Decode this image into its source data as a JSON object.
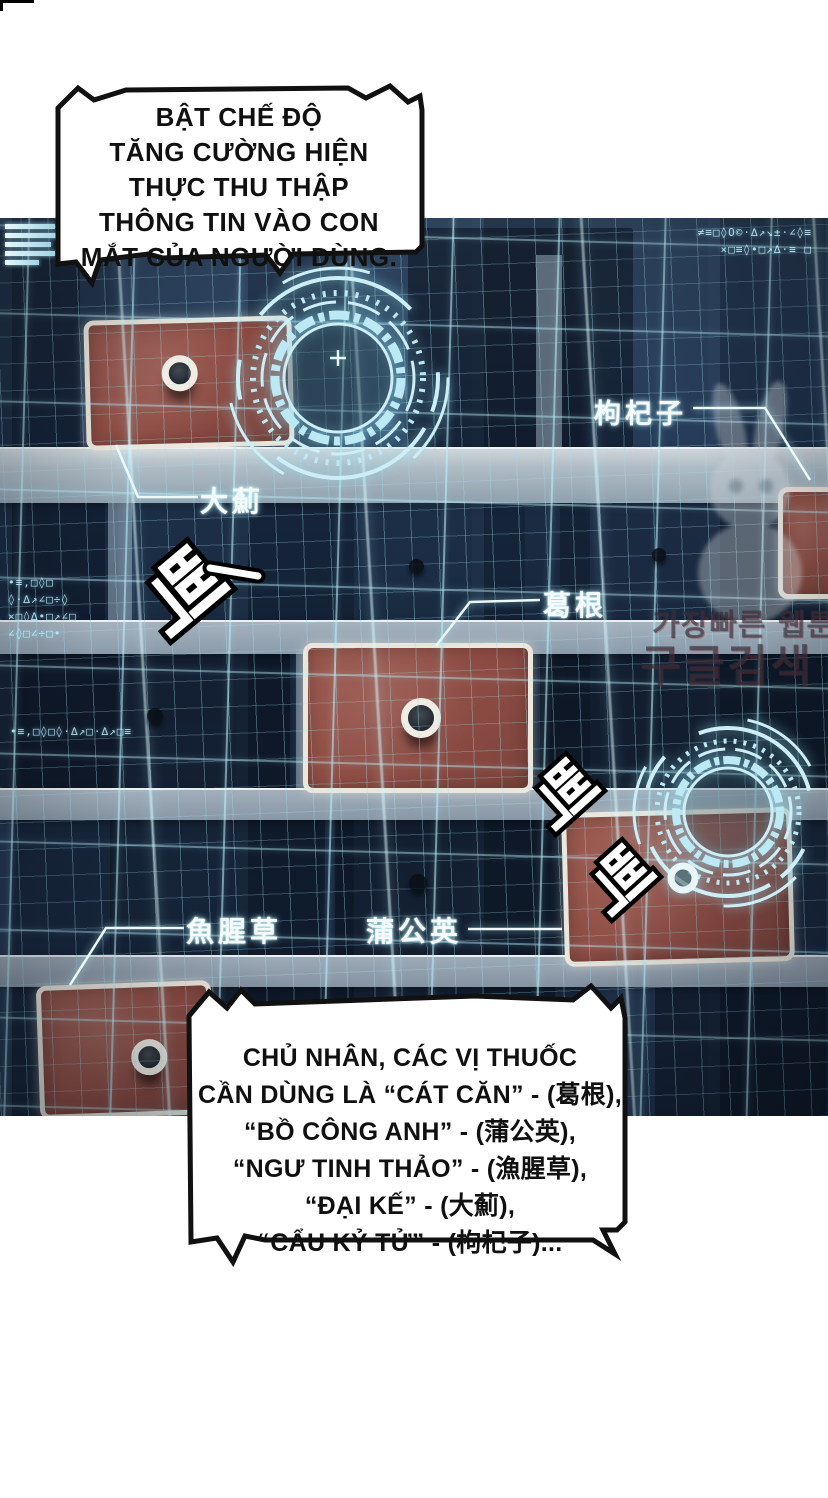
{
  "bubbles": {
    "top": {
      "lines": [
        "BẬT CHẾ ĐỘ",
        "TĂNG CƯỜNG HIỆN",
        "THỰC THU THẬP",
        "THÔNG TIN VÀO CON",
        "MẮT CỦA NGƯỜI DÙNG."
      ]
    },
    "bottom": {
      "lines": [
        "CHỦ NHÂN, CÁC VỊ THUỐC",
        "CẦN DÙNG LÀ “CÁT CĂN” - (葛根),",
        "“BỒ CÔNG ANH” - (蒲公英),",
        "“NGƯ TINH THẢO” - (漁腥草),",
        "“ĐẠI KẾ” - (大薊),",
        "“CẨU KỶ TỬ” - (枸杞子)..."
      ]
    }
  },
  "hud": {
    "herb_labels": [
      {
        "name": "dai-ji",
        "text": "大薊"
      },
      {
        "name": "cau-ky-tu",
        "text": "枸杞子"
      },
      {
        "name": "cat-can",
        "text": "葛根"
      },
      {
        "name": "ngu-tinh-thao",
        "text": "魚腥草"
      },
      {
        "name": "bo-cong-anh",
        "text": "蒲公英"
      }
    ],
    "sfx": {
      "beeps": [
        "삑",
        "삑",
        "삑"
      ],
      "dash": "—"
    },
    "glitch_text": {
      "top_right": [
        "≠≡□◊O©·∆↗↘±·∠◊≡",
        "×□≡◊•□↗∆·≡ □"
      ],
      "mid_left": [
        "•≡,□◊□",
        "◊·∆↗∠□÷◊",
        "×□◊∆•□↗∠□",
        "∠◊□∠÷□•"
      ],
      "low_left": "•≡,□◊□◊·∆↗□·∆↗□≡"
    },
    "icons": [
      "menu-bars-icon",
      "target-reticle-icon",
      "crosshair-icon",
      "equalizer-bars"
    ]
  },
  "watermark": {
    "line1": "가장빠른 웹툰",
    "line2": "구글검색"
  },
  "equalizer": {
    "bars": [
      25,
      87,
      77,
      42,
      39,
      55,
      37,
      10,
      18,
      33,
      28,
      25,
      43,
      12,
      27,
      55
    ]
  },
  "colors": {
    "accent_cyan": "#ace6f2",
    "grid_navy": "#1c2c42",
    "patch_red": "#8f4c43",
    "band_grey": "#9fadba",
    "bubble_border": "#111111",
    "sfx_fill": "#ffffff",
    "sfx_outline": "#000000"
  }
}
